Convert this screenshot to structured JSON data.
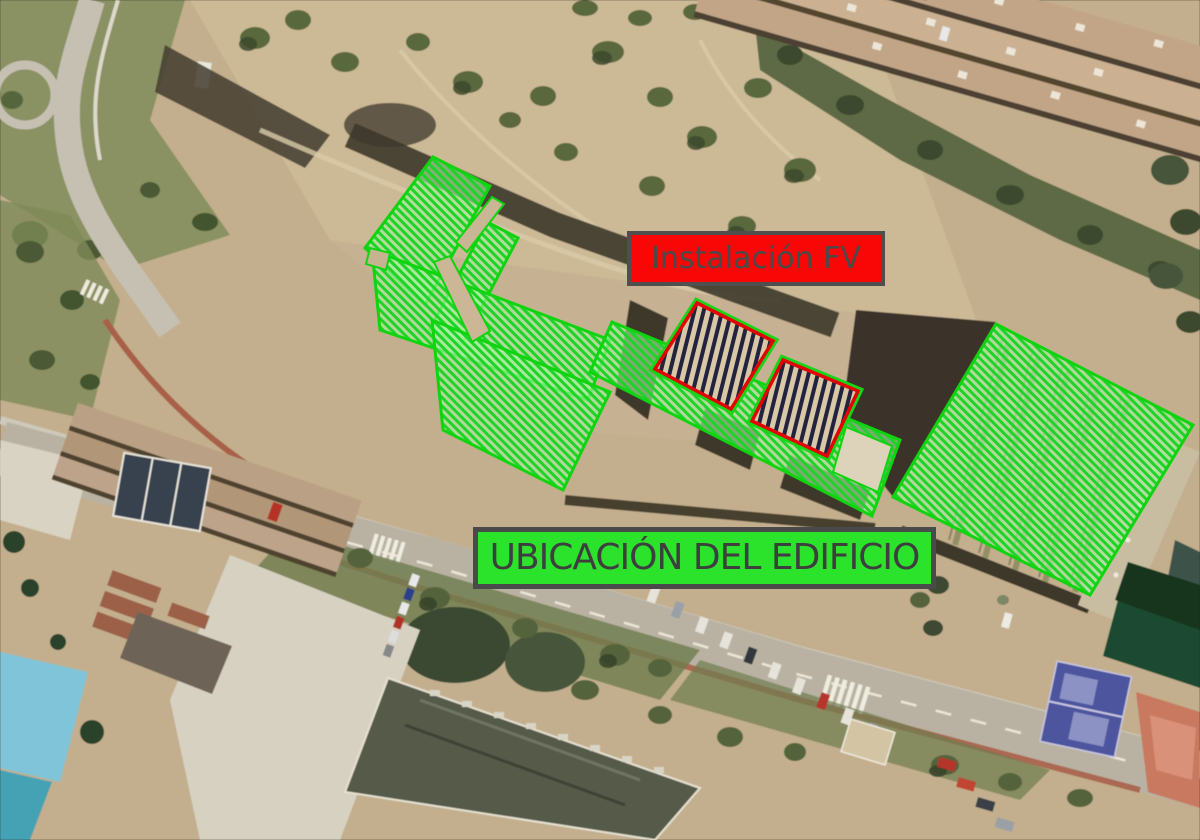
{
  "scene": {
    "width": 1200,
    "height": 840,
    "description": "aerial satellite view with building and PV annotation overlays"
  },
  "labels": {
    "pv": {
      "text": "Instalación FV",
      "box": {
        "left": 627,
        "top": 231,
        "width": 258,
        "height": 55
      },
      "bg": "#f90606",
      "border": "#4f4f4f",
      "color": "#4a4a4a",
      "font_size": 30
    },
    "building": {
      "text": "UBICACIÓN DEL EDIFICIO",
      "box": {
        "left": 473,
        "top": 527,
        "width": 463,
        "height": 62
      },
      "bg": "#2ce32c",
      "border": "#4a4a4a",
      "color": "#3e3e3e",
      "font_size": 36
    }
  },
  "overlay": {
    "green": {
      "stroke": "#0fd40f",
      "hatch_stripe": "#1ed428",
      "hatch_bg": "rgba(168,242,158,0.62)",
      "polygons": [
        {
          "name": "strip-north",
          "points": "433,157 490,186 425,305 365,248"
        },
        {
          "name": "prong",
          "points": "487,222 518,238 462,345 430,329"
        },
        {
          "name": "mass",
          "points": "372,250 610,340 588,400 380,330"
        },
        {
          "name": "lower-block",
          "points": "432,320 610,392 563,490 443,430"
        },
        {
          "name": "band",
          "points": "612,322 900,440 872,516 590,372"
        },
        {
          "name": "right-quad",
          "points": "996,324 1193,425 1090,595 893,497"
        }
      ],
      "gaps": [
        {
          "name": "roof-gap-corridor",
          "points": "456,242 492,197 504,204 467,252",
          "fill": "#c9b694"
        },
        {
          "name": "roof-gap-slot",
          "points": "434,262 450,256 490,331 472,342",
          "fill": "#cbb795"
        },
        {
          "name": "roof-gap-notch",
          "points": "370,248 390,253 386,270 366,264",
          "fill": "#c6b392"
        },
        {
          "name": "roof-gap-structure",
          "points": "846,427 892,446 878,492 833,472",
          "fill": "#ddd3ba"
        }
      ]
    },
    "pv_areas": {
      "stroke": "#e20505",
      "halo": "#17d417",
      "stripe": "#23233f",
      "fill": "#d9c8a6",
      "rects": [
        {
          "name": "pv-area-1",
          "points": "697,303 773,341 731,409 655,369"
        },
        {
          "name": "pv-area-2",
          "points": "783,360 858,391 827,456 752,421"
        }
      ]
    }
  }
}
